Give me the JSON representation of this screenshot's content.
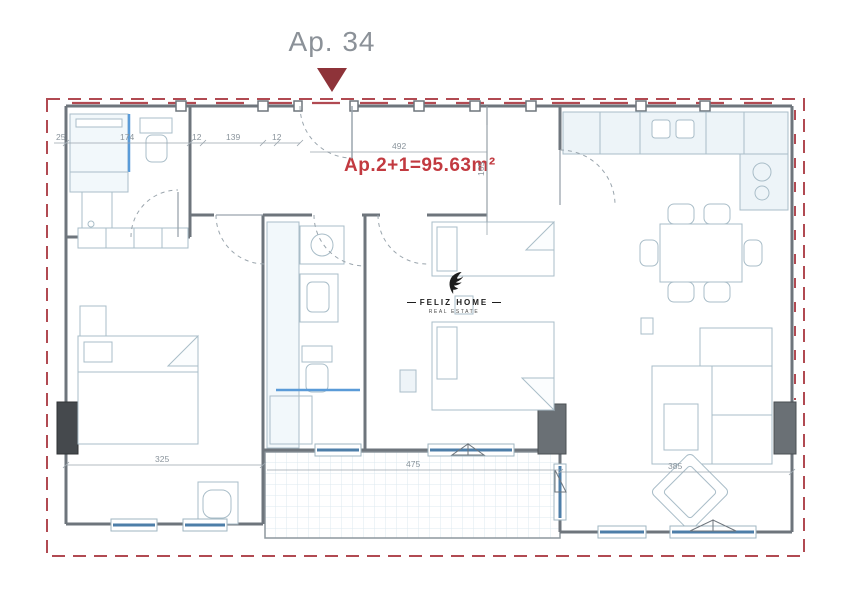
{
  "header": {
    "title": "Ap. 34"
  },
  "plan": {
    "area_label": "Ap.2+1=95.63m²"
  },
  "logo": {
    "brand": "FELIZ HOME",
    "tagline": "REAL ESTATE"
  },
  "dimensions": {
    "wall_left_offset": "25",
    "bath_width": "174",
    "wall_a": "12",
    "hall_left_width": "139",
    "wall_b": "12",
    "hall_width": "492",
    "hall_depth": "165",
    "bedroom_left_width": "325",
    "balcony_width": "475",
    "living_width": "385"
  },
  "colors": {
    "accent_red": "#c23a40",
    "marker_maroon": "#8e3339",
    "boundary_red": "#b14a52",
    "wall_gray": "#6e757c",
    "furniture_line": "#a9bdc8",
    "furniture_fill": "#edf4f8",
    "glazing_blue": "#4d7ea8",
    "column_dark": "#45494d",
    "column_gray": "#6a7075",
    "dimension_text": "#8a949c"
  }
}
